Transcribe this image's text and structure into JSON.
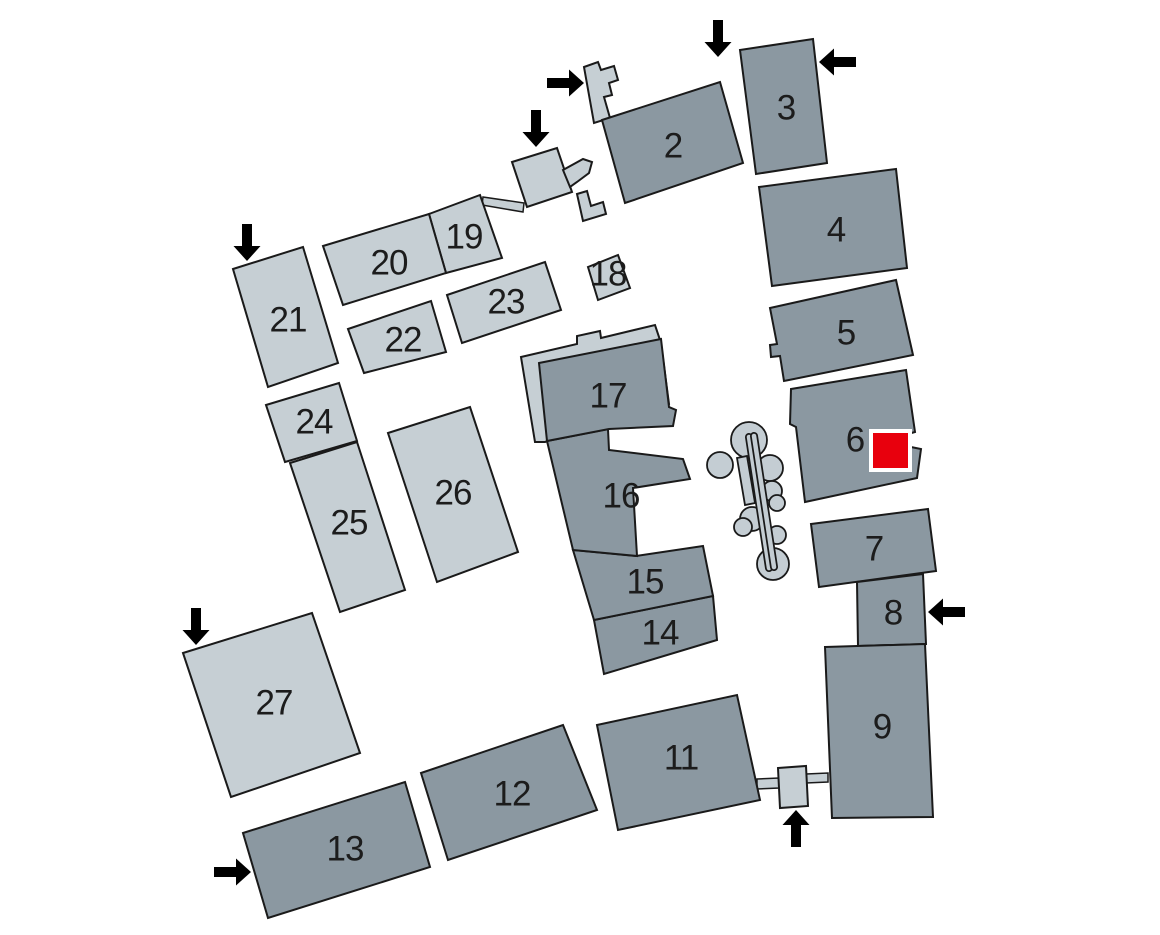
{
  "map": {
    "name": "Campus site plan",
    "background": "#ffffff",
    "colors": {
      "building_dark": "#8b98a1",
      "building_light": "#c6cfd4",
      "outline": "#1a1a1a",
      "tree": "#c4cdd3",
      "arrow": "#000000",
      "label": "#1c1c1c",
      "marker_fill": "#e8000d",
      "marker_border": "#ffffff"
    },
    "buildings": {
      "b2": {
        "label": "2",
        "shade": "dark"
      },
      "b3": {
        "label": "3",
        "shade": "dark"
      },
      "b4": {
        "label": "4",
        "shade": "dark"
      },
      "b5": {
        "label": "5",
        "shade": "dark"
      },
      "b6": {
        "label": "6",
        "shade": "dark"
      },
      "b7": {
        "label": "7",
        "shade": "dark"
      },
      "b8": {
        "label": "8",
        "shade": "dark"
      },
      "b9": {
        "label": "9",
        "shade": "dark"
      },
      "b11": {
        "label": "11",
        "shade": "dark"
      },
      "b12": {
        "label": "12",
        "shade": "dark"
      },
      "b13": {
        "label": "13",
        "shade": "dark"
      },
      "b14": {
        "label": "14",
        "shade": "dark"
      },
      "b15": {
        "label": "15",
        "shade": "dark"
      },
      "b16": {
        "label": "16",
        "shade": "dark"
      },
      "b17": {
        "label": "17",
        "shade": "dark"
      },
      "b18": {
        "label": "18",
        "shade": "light"
      },
      "b19": {
        "label": "19",
        "shade": "light"
      },
      "b20": {
        "label": "20",
        "shade": "light"
      },
      "b21": {
        "label": "21",
        "shade": "light"
      },
      "b22": {
        "label": "22",
        "shade": "light"
      },
      "b23": {
        "label": "23",
        "shade": "light"
      },
      "b24": {
        "label": "24",
        "shade": "light"
      },
      "b25": {
        "label": "25",
        "shade": "light"
      },
      "b26": {
        "label": "26",
        "shade": "light"
      },
      "b27": {
        "label": "27",
        "shade": "light"
      }
    },
    "marker": {
      "shape": "square",
      "fill": "#e8000d",
      "border": "#ffffff",
      "at_building": "6"
    },
    "entrances": [
      {
        "direction": "right",
        "location": "annex north of building 2"
      },
      {
        "direction": "down",
        "location": "north of building 2"
      },
      {
        "direction": "left",
        "location": "east of building 3"
      },
      {
        "direction": "down",
        "location": "pavilion north-west of building 2"
      },
      {
        "direction": "down",
        "location": "north of building 21"
      },
      {
        "direction": "down",
        "location": "north of building 27"
      },
      {
        "direction": "right",
        "location": "west of building 13"
      },
      {
        "direction": "up",
        "location": "pavilion between buildings 11 and 9"
      },
      {
        "direction": "left",
        "location": "east of building 8"
      }
    ],
    "landscape": {
      "tree_count": 9,
      "hedge_count": 1,
      "footpath_count": 2
    }
  }
}
